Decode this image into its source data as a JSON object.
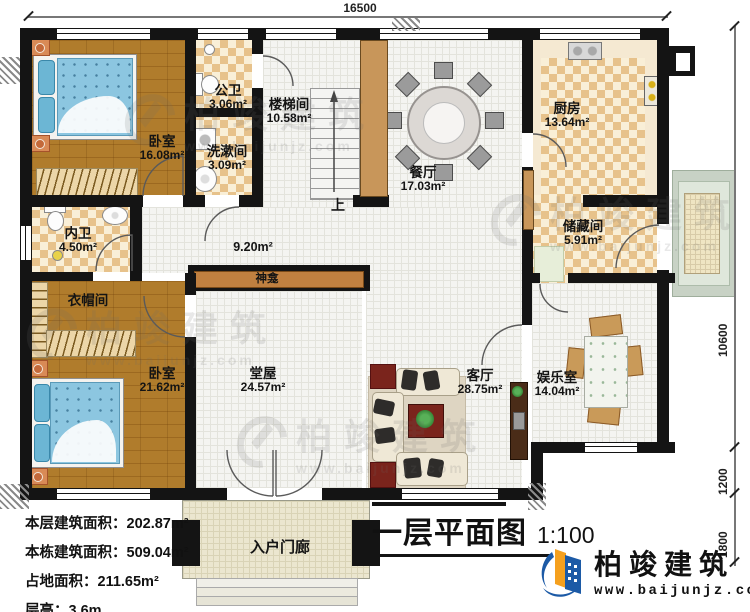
{
  "plan": {
    "dimensions": {
      "top_width": "16500",
      "right_main": "10600",
      "right_porch": "1200",
      "right_steps": "1800"
    },
    "rooms": {
      "bedroom1": {
        "name": "卧室",
        "area": "16.08m²"
      },
      "public_bath": {
        "name": "公卫",
        "area": "3.06m²"
      },
      "washroom": {
        "name": "洗漱间",
        "area": "3.09m²"
      },
      "stairhall": {
        "name": "楼梯间",
        "area": "10.58m²"
      },
      "dining": {
        "name": "餐厅",
        "area": "17.03m²"
      },
      "kitchen": {
        "name": "厨房",
        "area": "13.64m²"
      },
      "storage": {
        "name": "储藏间",
        "area": "5.91m²"
      },
      "inner_bath": {
        "name": "内卫",
        "area": "4.50m²"
      },
      "cloakroom": {
        "name": "衣帽间"
      },
      "bedroom2": {
        "name": "卧室",
        "area": "21.62m²"
      },
      "main_hall": {
        "name": "堂屋",
        "area": "24.57m²"
      },
      "living": {
        "name": "客厅",
        "area": "28.75m²"
      },
      "entertainment": {
        "name": "娱乐室",
        "area": "14.04m²"
      },
      "porch": {
        "name": "入户门廊"
      }
    },
    "corridor_area": "9.20m²",
    "shrine_label": "神龛",
    "stairs_up_label": "上",
    "stats": [
      "本层建筑面积：202.87m²",
      "本栋建筑面积：509.04m²",
      "占地面积：211.65m²",
      "层高：3.6m"
    ],
    "title": {
      "text": "一层平面图",
      "scale": "1:100"
    },
    "brand": {
      "name": "柏竣建筑",
      "url": "www.baijunjz.com"
    },
    "watermark": {
      "name": "柏竣建筑",
      "url": "www.baijunjz.com"
    },
    "colors": {
      "accent_blue": "#1c5aa6",
      "accent_orange": "#f5a01e",
      "wall": "#141414",
      "shrine_band": "#c08040"
    }
  }
}
